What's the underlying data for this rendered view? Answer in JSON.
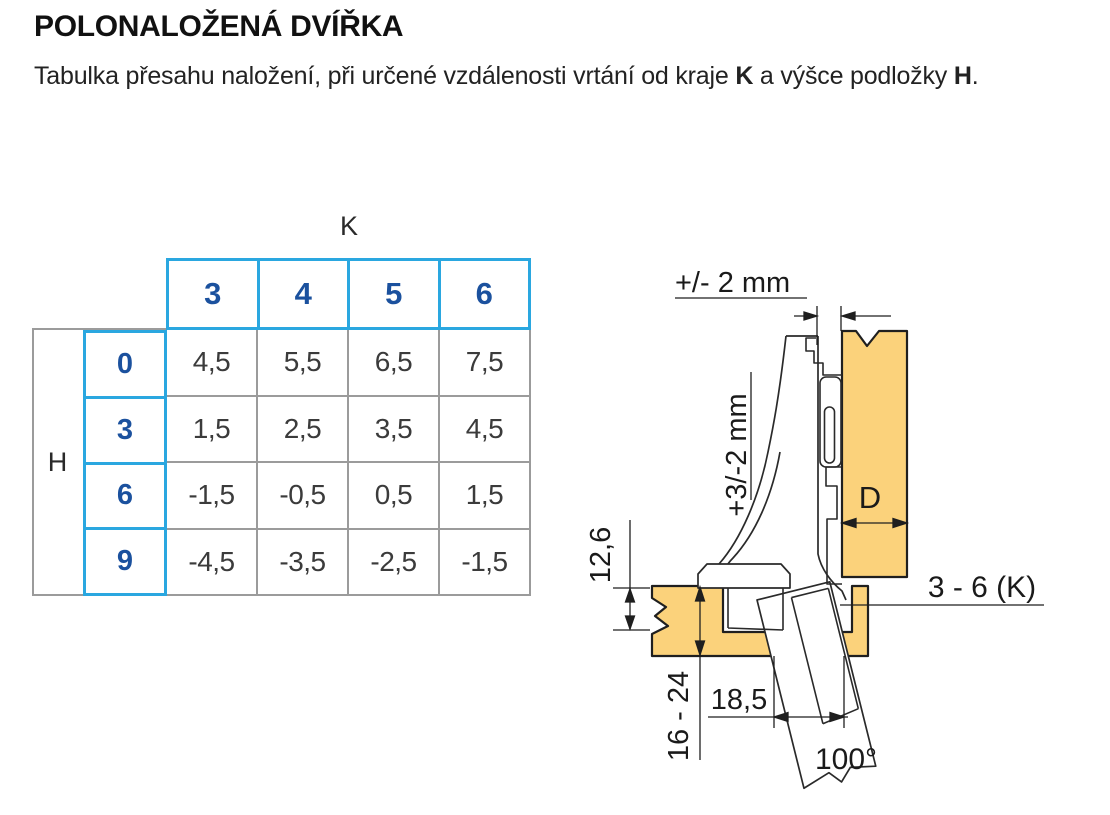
{
  "page": {
    "title": "POLONALOŽENÁ DVÍŘKA",
    "subtitle": {
      "text_before_k": "Tabulka přesahu naložení, při určené vzdálenosti vrtání od kraje ",
      "k_bold": "K",
      "text_between": " a výšce podložky ",
      "h_bold": "H",
      "text_after": "."
    }
  },
  "chart_data": {
    "type": "table",
    "title": "Tabulka přesahu naložení (polonaložená dvířka)",
    "column_axis_label": "K",
    "row_axis_label": "H",
    "columns": [
      "3",
      "4",
      "5",
      "6"
    ],
    "rows": [
      "0",
      "3",
      "6",
      "9"
    ],
    "values": [
      [
        "4,5",
        "5,5",
        "6,5",
        "7,5"
      ],
      [
        "1,5",
        "2,5",
        "3,5",
        "4,5"
      ],
      [
        "-1,5",
        "-0,5",
        "0,5",
        "1,5"
      ],
      [
        "-4,5",
        "-3,5",
        "-2,5",
        "-1,5"
      ]
    ]
  },
  "table": {
    "k_label": "K",
    "h_label": "H",
    "col_headers": [
      "3",
      "4",
      "5",
      "6"
    ],
    "rows": [
      {
        "h": "0",
        "values": [
          "4,5",
          "5,5",
          "6,5",
          "7,5"
        ]
      },
      {
        "h": "3",
        "values": [
          "1,5",
          "2,5",
          "3,5",
          "4,5"
        ]
      },
      {
        "h": "6",
        "values": [
          "-1,5",
          "-0,5",
          "0,5",
          "1,5"
        ]
      },
      {
        "h": "9",
        "values": [
          "-4,5",
          "-3,5",
          "-2,5",
          "-1,5"
        ]
      }
    ]
  },
  "diagram": {
    "labels": {
      "depth_adjustment": "+/- 2 mm",
      "height_adjustment": "+3/-2 mm",
      "cup_depth": "12,6",
      "door_thickness": "16 - 24",
      "cup_distance": "18,5",
      "opening_angle": "100°",
      "overlay": "3 - 6 (K)",
      "panel_depth": "D"
    }
  },
  "colors": {
    "accent_cyan": "#2aa7e0",
    "header_blue": "#1b519e",
    "grid_gray": "#9b9b9b",
    "wood": "#fbd27b",
    "line": "#1f1f1f"
  }
}
